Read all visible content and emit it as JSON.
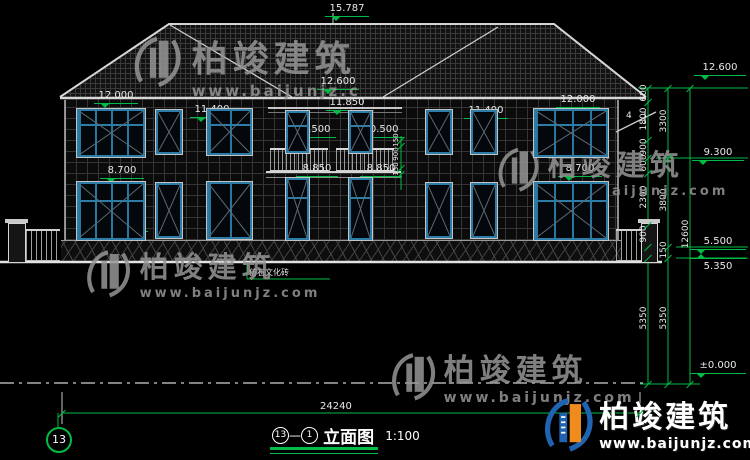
{
  "brand": {
    "name": "柏竣建筑",
    "url": "www.baijunjz.com",
    "url_short": "www.baijunjz.c"
  },
  "levels": [
    "15.787",
    "12.600",
    "11.850",
    "12.000",
    "11.400",
    "10.250",
    "8.700",
    "6.450",
    "10.500",
    "10.500",
    "8.850",
    "8.850",
    "12.000",
    "11.400",
    "10.250",
    "8.700",
    "6.450",
    "12.600",
    "9.300",
    "5.500",
    "5.350",
    "±0.000"
  ],
  "chains": {
    "inner": [
      "600",
      "1800",
      "900",
      "600",
      "2300",
      "900",
      "5350"
    ],
    "middle": [
      "3300",
      "3800",
      "150",
      "5350"
    ],
    "outer": [
      "12600"
    ],
    "balcony": [
      "150",
      "900",
      "150"
    ]
  },
  "dims": {
    "overall_width": "24240"
  },
  "title": {
    "from_no": "13",
    "dash": "—",
    "to_no": "1",
    "name": "立面图",
    "scale": "1:100"
  },
  "sheet": {
    "no": "13"
  },
  "notes": {
    "material": "仿石文化砖",
    "roof_slope": "4"
  }
}
